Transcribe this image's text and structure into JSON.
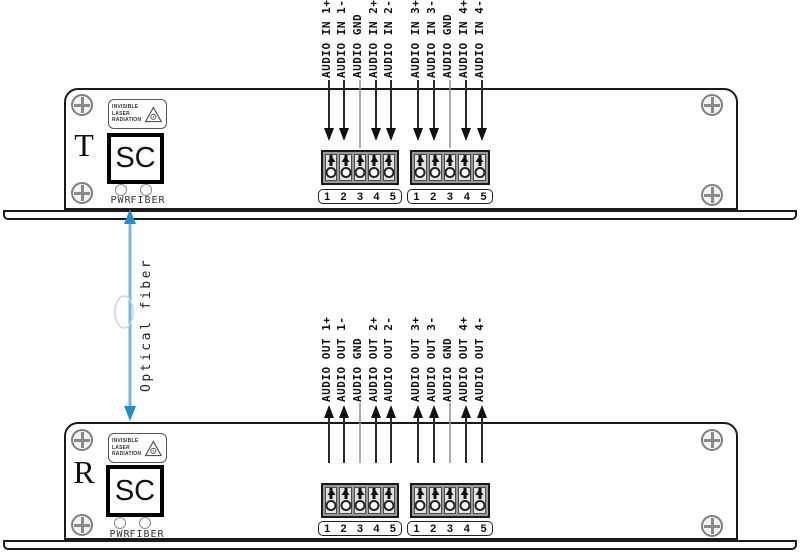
{
  "diagram": {
    "fiber_link_label": "Optical fiber",
    "fiber_line_color": "#74b9e0",
    "fiber_head_color": "#1d8fd2",
    "wire_color": "#2a2a2a",
    "gnd_wire_color": "#909090"
  },
  "audio_in_labels": [
    "AUDIO IN 1+",
    "AUDIO IN 1-",
    "AUDIO GND",
    "AUDIO IN 2+",
    "AUDIO IN 2-",
    "AUDIO IN 3+",
    "AUDIO IN 3-",
    "AUDIO GND",
    "AUDIO IN 4+",
    "AUDIO IN 4-"
  ],
  "audio_out_labels": [
    "AUDIO OUT 1+",
    "AUDIO OUT 1-",
    "AUDIO GND",
    "AUDIO OUT 2+",
    "AUDIO OUT 2-",
    "AUDIO OUT 3+",
    "AUDIO OUT 3-",
    "AUDIO GND",
    "AUDIO OUT 4+",
    "AUDIO OUT 4-"
  ],
  "transmitter": {
    "designator": "T",
    "connector_label": "SC",
    "warning": {
      "line1": "INVISIBLE",
      "line2": "LASER",
      "line3": "RADIATION"
    },
    "led_labels": {
      "pwr": "PWR",
      "fiber": "FIBER"
    },
    "terminal_numbers": [
      "1",
      "2",
      "3",
      "4",
      "5"
    ]
  },
  "receiver": {
    "designator": "R",
    "connector_label": "SC",
    "warning": {
      "line1": "INVISIBLE",
      "line2": "LASER",
      "line3": "RADIATION"
    },
    "led_labels": {
      "pwr": "PWR",
      "fiber": "FIBER"
    },
    "terminal_numbers": [
      "1",
      "2",
      "3",
      "4",
      "5"
    ]
  }
}
